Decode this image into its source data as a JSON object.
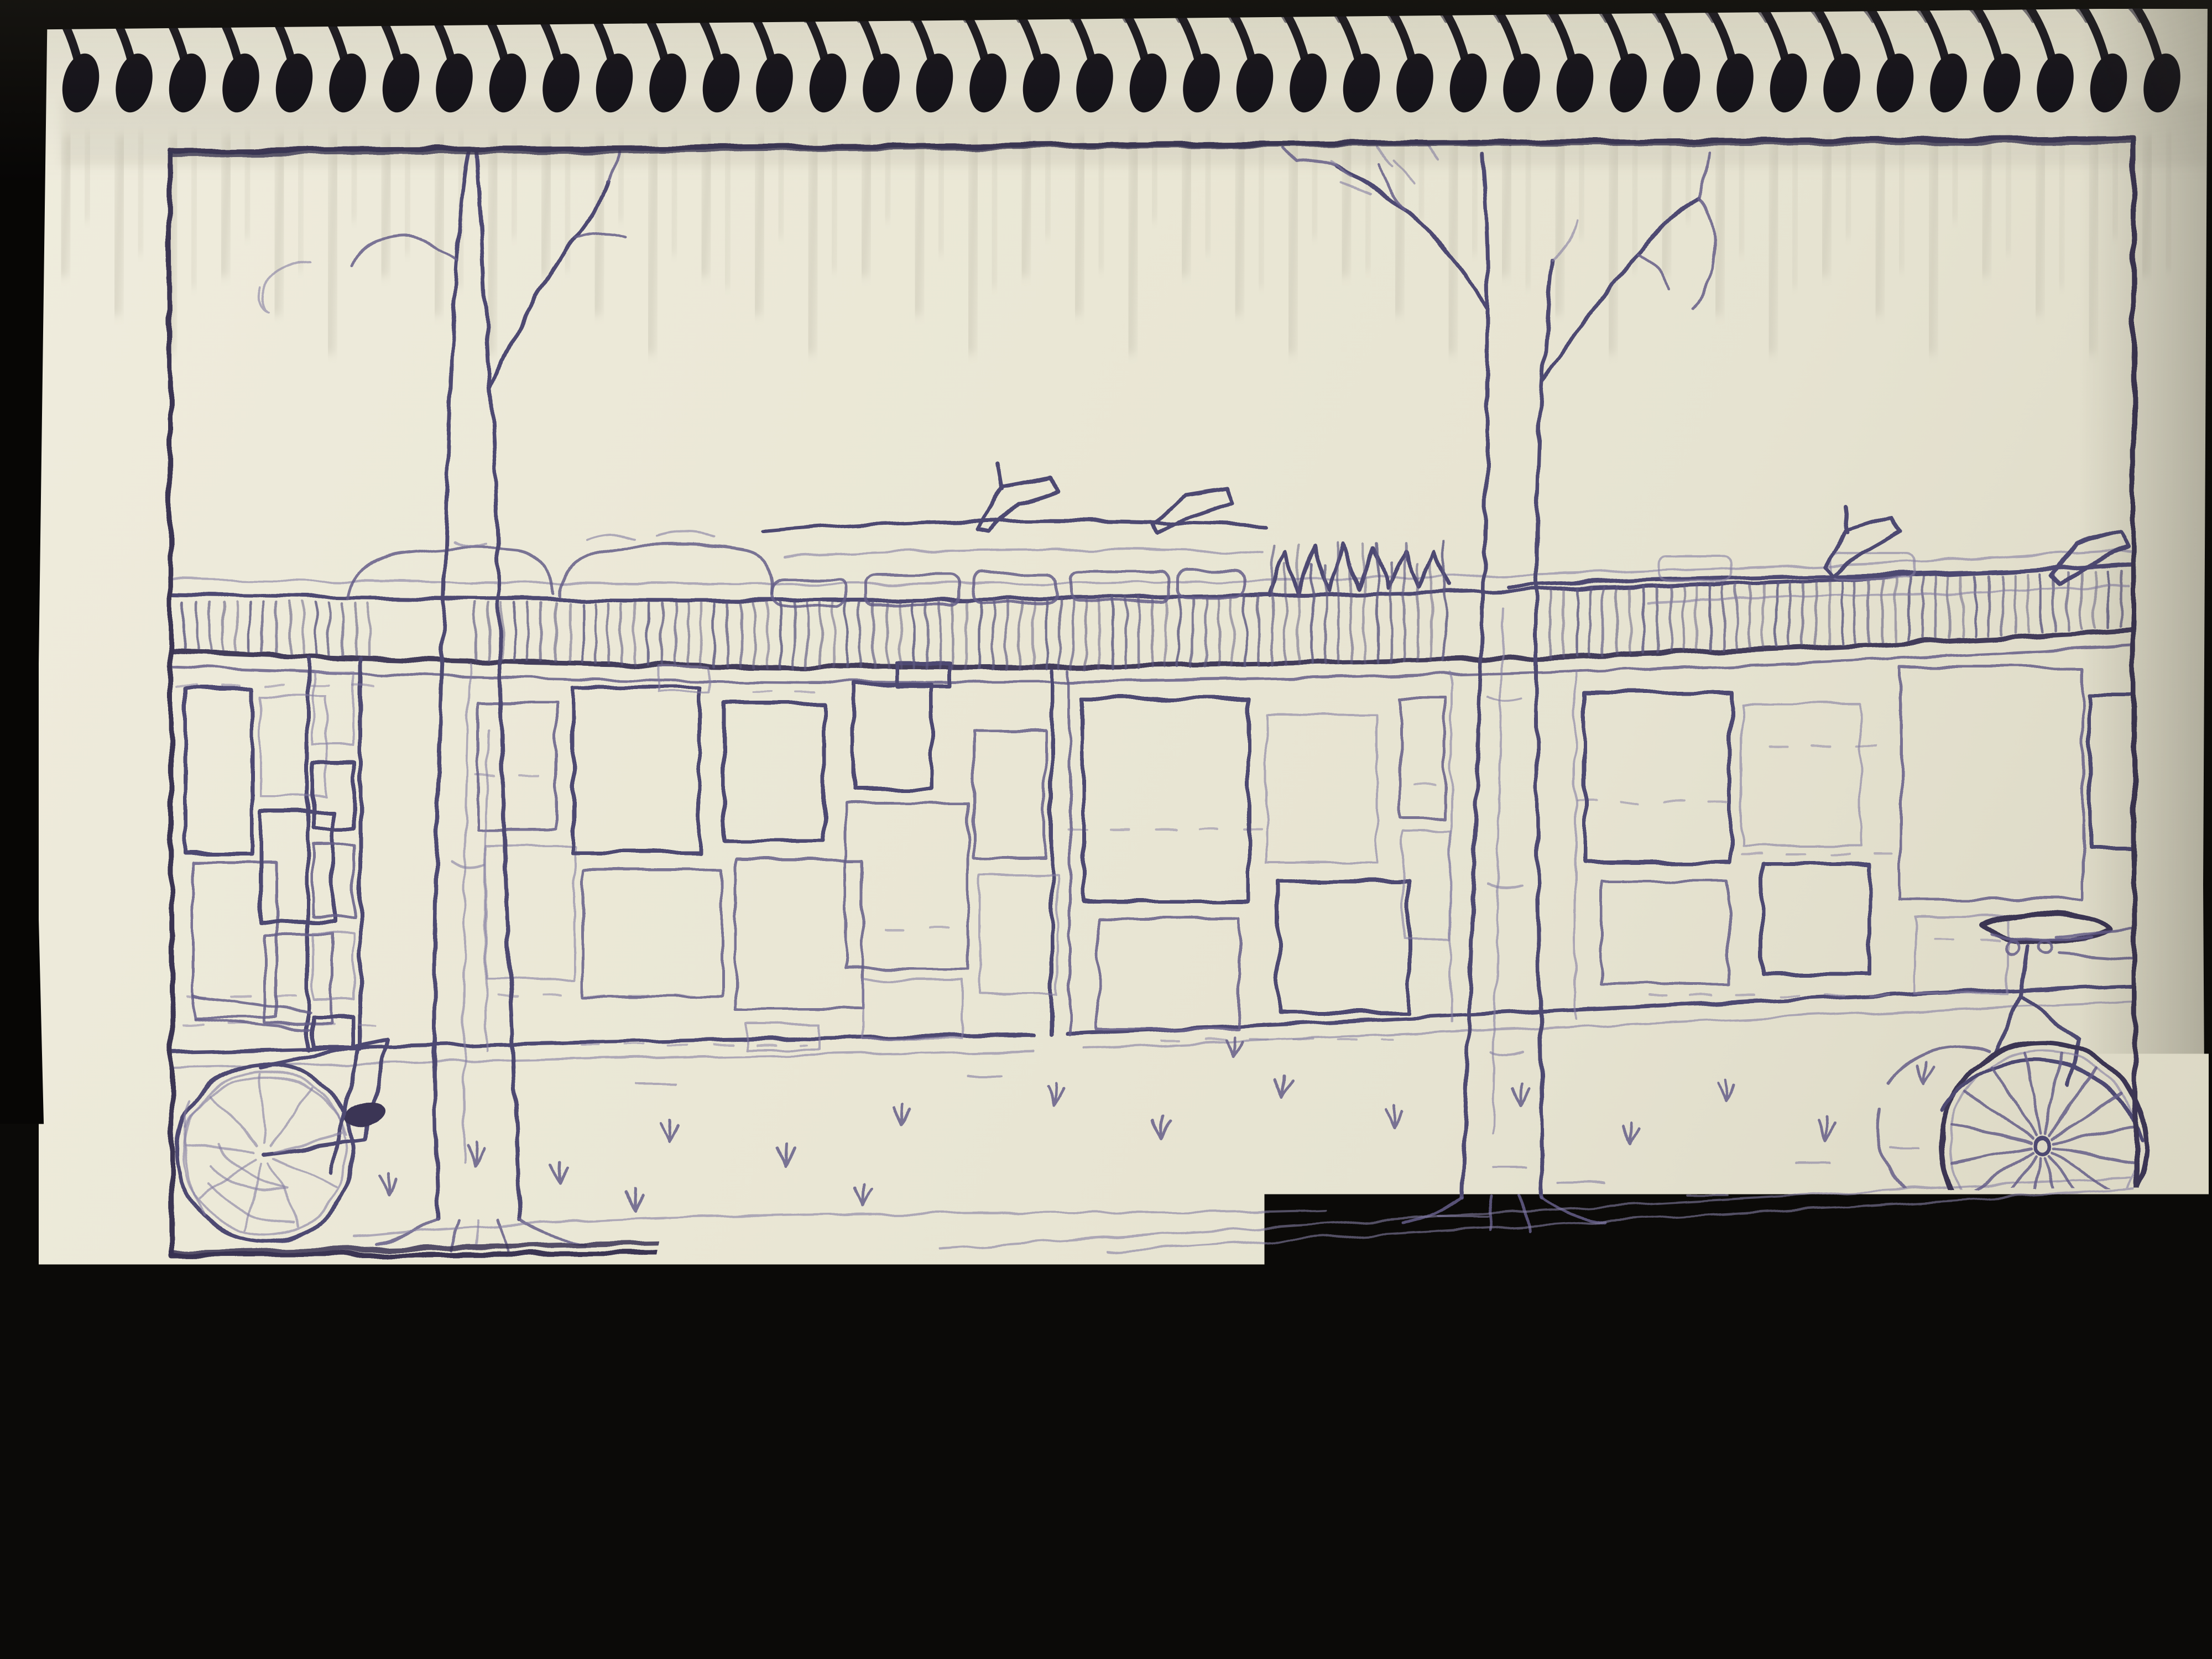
{
  "calendar": {
    "year": "1978",
    "month": "11",
    "caption": {
      "lines": [
        "“西单民主墙”是我记忆中最深刻的墙。那时五年级十二岁的我并不知“民主”的深意，但那是我第一次",
        "体会了什么是“自由”。当那堵被众多大字报、小字报贴满的墙被在一夜之间清洗得干干净净的时",
        "候，我开始知道“自由”是不易的，但那“自由”却牢牢地印在了我年幼的心里，清洗不去。"
      ]
    },
    "colors": {
      "background": "#0b0a08",
      "paper": "#e9e6d4",
      "ink": "#463f66",
      "pencil": "#56507a"
    }
  }
}
